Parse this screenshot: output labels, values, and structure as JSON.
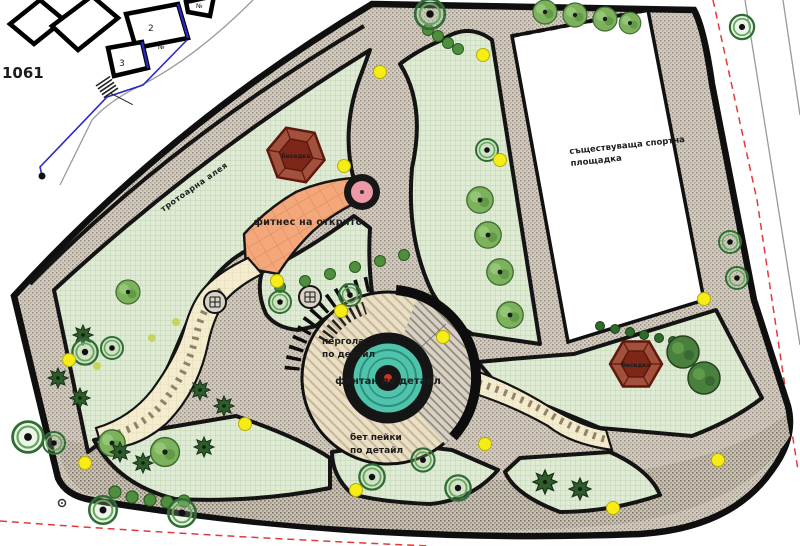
{
  "title": "park landscape site plan",
  "labels": {
    "parcel_number": "1061",
    "building_2": "2",
    "building_3": "3",
    "building_no_a": "№",
    "building_no_b": "№",
    "playground_line1": "съществуваща спортна",
    "playground_line2": "площадка",
    "fitness": "фитнес на открито",
    "pergola_line1": "пергола",
    "pergola_line2": "по детайл",
    "fountain": "фонтан по детайл",
    "benches_line1": "бет пейки",
    "benches_line2": "по детайл",
    "gazebo_top": "беседка",
    "gazebo_right": "беседка",
    "alley": "тротоарна алея"
  },
  "colors": {
    "paper": "#ffffff",
    "lawn": "#dfebd5",
    "lawn_grid": "#b7cda6",
    "pavement": "#d3ccc2",
    "pavement_dark": "#c8c1b5",
    "plaza_tan": "#eadfc8",
    "plaza_hatch": "#c9b894",
    "fitness_orange": "#f3a77a",
    "cream_path": "#f4eccf",
    "fountain_water": "#4fc3ab",
    "lamp_yellow": "#f6ec16",
    "boundary_red": "#e03a3a",
    "parcel_blue": "#2a2ac8",
    "gazebo_red": "#9a3b28",
    "tree_green": "#2f6d35",
    "ink": "#141414"
  }
}
